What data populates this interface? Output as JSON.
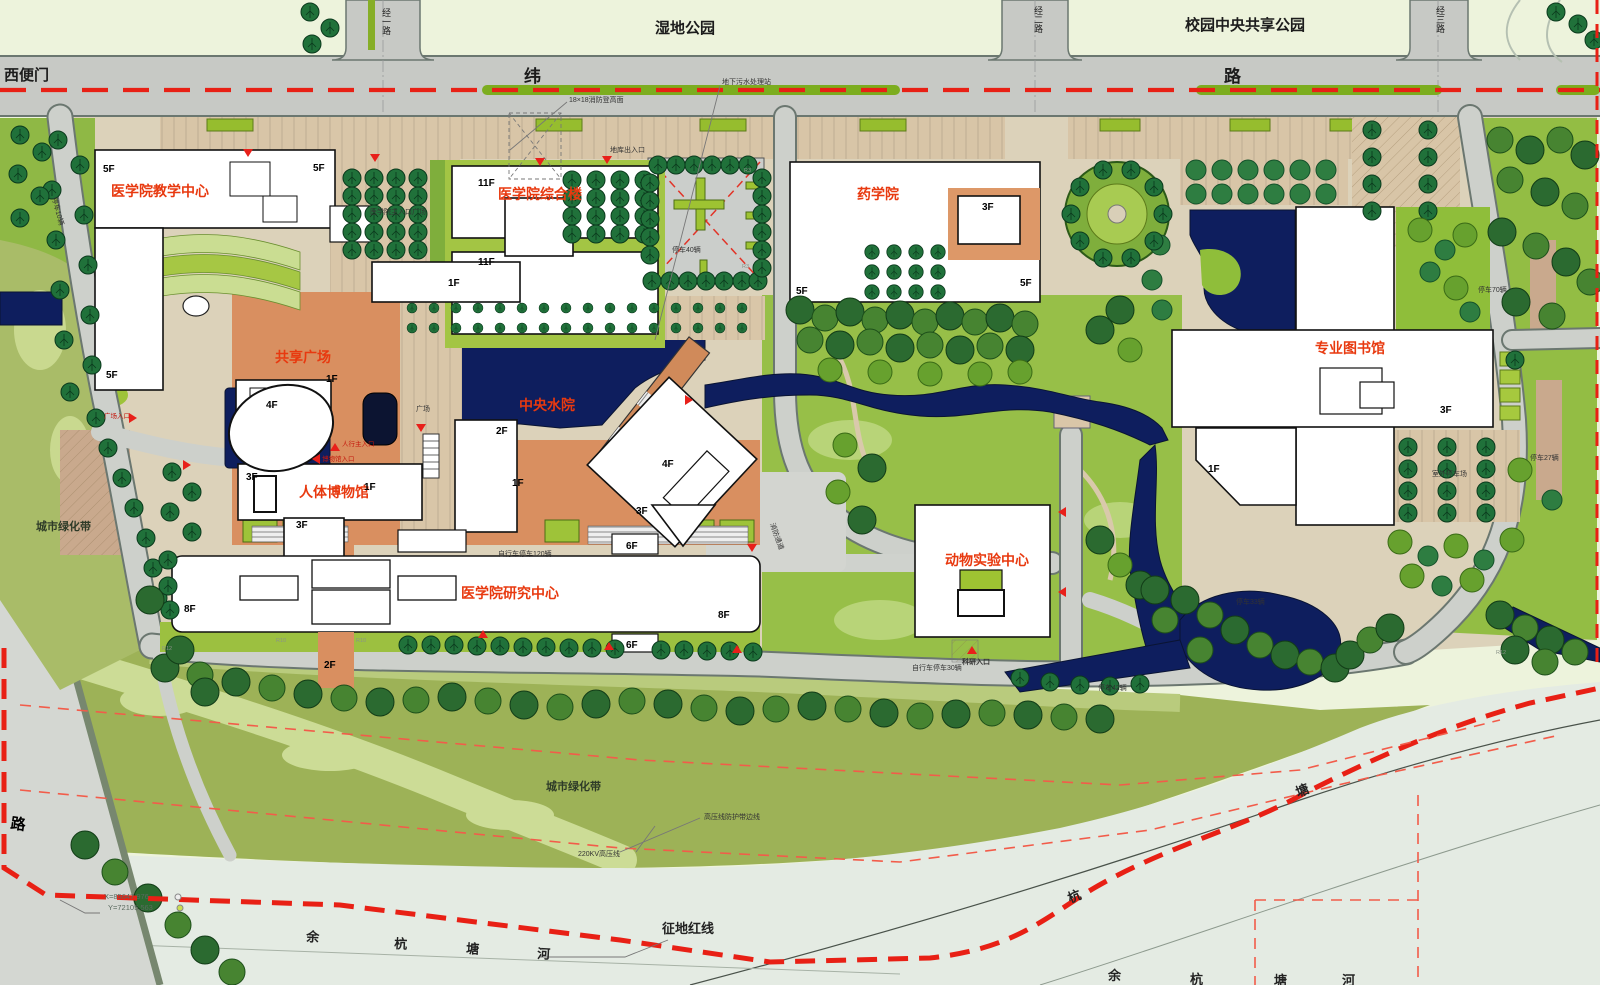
{
  "m": {
    "wetland_park": "湿地公园",
    "central_park": "校园中央共享公园",
    "west_gate": "西便门",
    "road_wei": "纬",
    "road_lu": "路",
    "jing1": "经一路",
    "jing2": "经二路",
    "jing3": "经三路",
    "city_road": "路",
    "green_belt": "城市绿化带",
    "red_line": "征地红线",
    "river": [
      "余",
      "杭",
      "塘",
      "河"
    ],
    "outer": [
      "杭",
      "塘"
    ],
    "b": {
      "teaching": "医学院教学中心",
      "complex": "医学院综合楼",
      "pharmacy": "药学院",
      "library": "专业图书馆",
      "plaza": "共享广场",
      "water": "中央水院",
      "museum": "人体博物馆",
      "research": "医学院研究中心",
      "animal": "动物实验中心"
    },
    "floors": [
      "5F",
      "5F",
      "5F",
      "11F",
      "11F",
      "1F",
      "3F",
      "5F",
      "5F",
      "3F",
      "1F",
      "4F",
      "1F",
      "2F",
      "3F",
      "3F",
      "1F",
      "1F",
      "4F",
      "3F",
      "6F",
      "6F",
      "8F",
      "8F",
      "2F"
    ],
    "ann": {
      "fire_ladder": "18×18消防登高面",
      "sewage": "地下污水处理站",
      "garage": "地库出入口",
      "main_plaza": "医学院主入口广场",
      "plaza_s": "广场",
      "fire_lane": "消防通道",
      "hv_edge": "高压线防护带边线",
      "hv": "220KV高压线",
      "cx": "X=85647.976",
      "cy": "Y=72105.563"
    },
    "ent": {
      "plaza": "广场入口",
      "ped": "人行主入口",
      "museum": "博物馆入口",
      "research": "科研入口"
    },
    "p": {
      "p40": "停车40辆",
      "p70": "停车70辆",
      "p27": "停车27辆",
      "p33": "停车33辆",
      "p42": "停车42辆",
      "p10": "停车10辆",
      "out": "室外停车场",
      "bike120": "自行车停车120辆",
      "bike30": "自行车停车30辆"
    },
    "r": {
      "r3": "R3",
      "r10": "R10",
      "r12": "R12"
    }
  },
  "colors": {
    "water": "#0e1e5e",
    "plaza_orange": "#d98f60",
    "lawn": "#a5c748",
    "road_gray": "#c9cbc7",
    "tree_dark": "#20713a",
    "red_label": "#e8390f",
    "red_line": "#e82015",
    "paving_tan": "#d9c6a8",
    "belt_olive": "#9db257",
    "river_pale": "#e4ebe3",
    "park_pale": "#edf3dc"
  }
}
